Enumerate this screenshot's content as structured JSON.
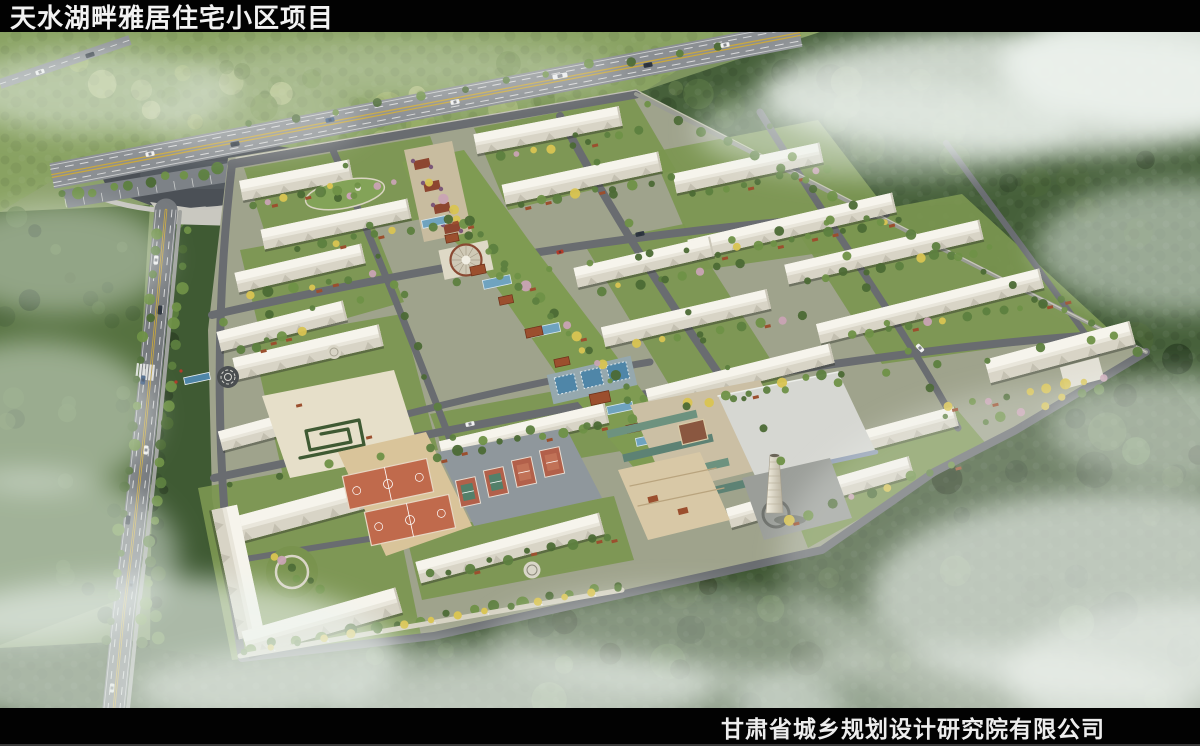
{
  "header": {
    "title": "天水湖畔雅居住宅小区项目"
  },
  "footer": {
    "company": "甘肃省城乡规划设计研究院有限公司"
  },
  "palette": {
    "bar_bg": "#020202",
    "bar_text": "#f0f0f0",
    "field": "#8fa768",
    "hill": "#89a262",
    "forest_dark": "#3c5430",
    "forest_deep": "#2c4026",
    "site_base": "#9fa38c",
    "grass": "#7b9650",
    "street": "#696c70",
    "main_road": "#8b8f93",
    "left_road": "#75797d",
    "building": "#e9e6db",
    "building_shade": "#d8d4c6",
    "roof_light": "#f6f4ec",
    "water": "#6fa3bf",
    "pool": "#4f86a8",
    "lake": "#4b5056",
    "pavilion": "#9b4f2e",
    "awning": "#7b5878",
    "court_orange": "#c06a4c",
    "court_apron": "#d9c49a",
    "tennis_red": "#b2604a",
    "tennis_green": "#53806a",
    "tennis_base": "#8f979c",
    "commercial_teal": "#5d8274",
    "commercial_tan": "#cbbfa4",
    "big_roof": "#d6d7d2",
    "chimney_light": "#f4f0e2",
    "chimney_dark": "#b7b09d",
    "tree_green": "#4c6a35",
    "tree_mid": "#5d7f3f",
    "tree_light": "#6f9147",
    "tree_yellow": "#d9c452",
    "tree_pink": "#c9a3b4",
    "promenade": "#d6d2c2",
    "fog": "#eef3ef",
    "center_line": "#c9a83f",
    "lane_mark": "#e8e8e8"
  }
}
